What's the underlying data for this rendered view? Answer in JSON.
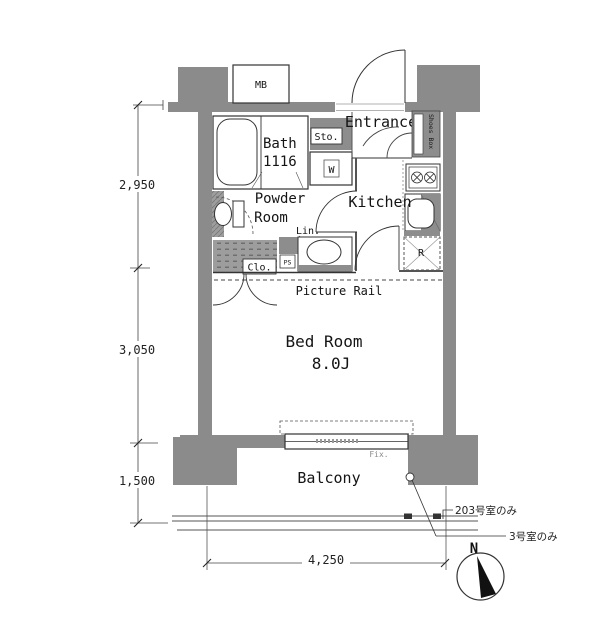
{
  "rooms": {
    "bath": {
      "name": "Bath",
      "size": "1116"
    },
    "powder": {
      "line1": "Powder",
      "line2": "Room"
    },
    "entrance": {
      "name": "Entrance"
    },
    "kitchen": {
      "name": "Kitchen"
    },
    "bedroom": {
      "name": "Bed Room",
      "size": "8.0J"
    },
    "balcony": {
      "name": "Balcony"
    }
  },
  "fixtures": {
    "meter_box": "MB",
    "storage": "Sto.",
    "washing_machine": "W",
    "shoes_box": "Shoes Box",
    "linen": "Lin.",
    "closet": "Clo.",
    "pipe_space": "PS",
    "refrigerator": "R",
    "picture_rail": "Picture Rail",
    "fixed_window": "Fix."
  },
  "dimensions": {
    "left_upper": "2,950",
    "left_middle": "3,050",
    "left_lower": "1,500",
    "bottom": "4,250"
  },
  "notes": {
    "room_203_only": "203号室のみ",
    "room_3_only": "3号室のみ"
  },
  "compass": {
    "north": "N"
  },
  "colors": {
    "wall": "#8b8b8b",
    "fixture_gray": "#8d8d8d",
    "hatch_gray": "#9d9d9d",
    "line": "#333333",
    "background": "#ffffff"
  }
}
